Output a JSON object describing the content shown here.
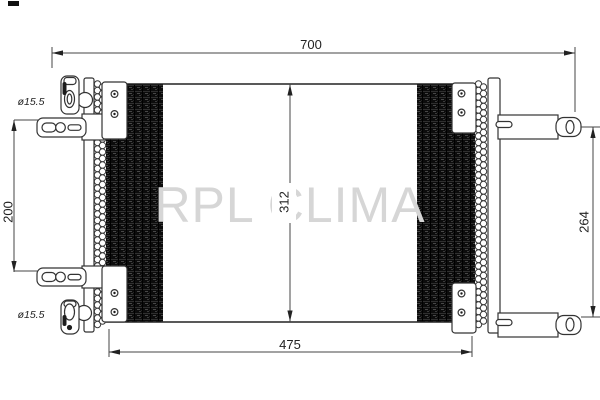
{
  "watermark": {
    "text": "RPL CLIMA",
    "color": "#d6d6d6"
  },
  "dims": {
    "w700": "700",
    "w475": "475",
    "h312": "312",
    "h200": "200",
    "h264": "264",
    "port_top": "ø15.5",
    "port_bottom": "ø15.5"
  },
  "colors": {
    "line": "#333333",
    "fin_dark": "#0c0c0c",
    "background": "#ffffff"
  }
}
